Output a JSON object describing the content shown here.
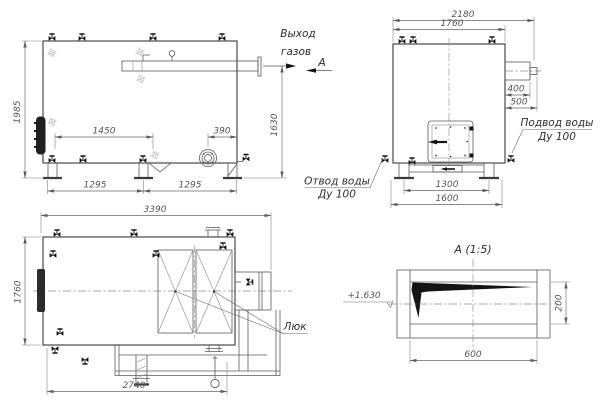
{
  "views": {
    "side": {
      "dims": {
        "height": "1985",
        "gas_outlet_height": "1630",
        "valve_span": "1450",
        "burner_offset": "390",
        "leg_span_left": "1295",
        "leg_span_right": "1295"
      },
      "labels": {
        "gas_outlet_line1": "Выход",
        "gas_outlet_line2": "газов",
        "view_letter": "А"
      }
    },
    "front": {
      "dims": {
        "overall_width": "2180",
        "body_width": "1760",
        "duct_depth": "400",
        "duct_reach": "500",
        "base_span": "1300",
        "base_width": "1600"
      },
      "labels": {
        "water_inlet_line1": "Подвод воды",
        "water_inlet_line2": "Ду 100",
        "water_outlet_line1": "Отвод воды",
        "water_outlet_line2": "Ду 100"
      }
    },
    "plan": {
      "dims": {
        "length": "3390",
        "width": "1760",
        "frame_length": "2740"
      },
      "labels": {
        "hatch": "Люк"
      }
    },
    "detail": {
      "title": "А (1:5)",
      "dims": {
        "height": "200",
        "width": "600"
      },
      "labels": {
        "elevation": "+1.630"
      }
    }
  },
  "colors": {
    "background": "#ffffff",
    "line": "#4f4f4f",
    "dimension": "#666666",
    "text": "#2e2e2e"
  }
}
